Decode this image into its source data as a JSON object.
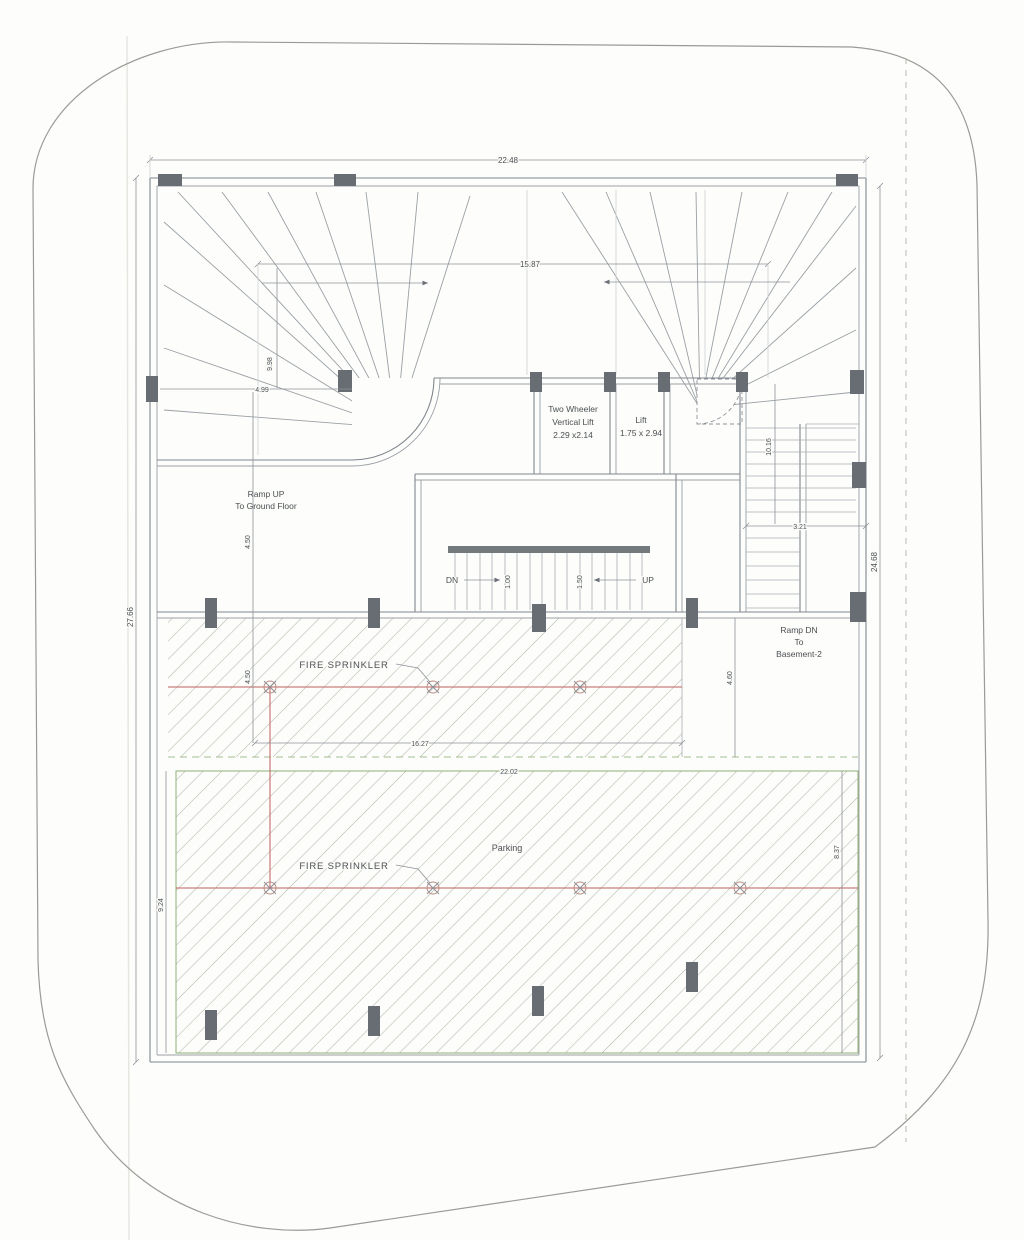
{
  "dims": {
    "top": "22.48",
    "inner_top": "15.87",
    "left": "27.66",
    "right": "24.68",
    "ramp_left_len": "9.98",
    "ramp_left_w": "4.99",
    "mid_left_a": "4.50",
    "mid_left_b": "4.50",
    "mid_right": "4.60",
    "ramp_dn_len": "10.16",
    "ramp_dn_w": "3.21",
    "parking_upper_w": "16.27",
    "parking_lower_w": "22.02",
    "lower_right": "8.37",
    "lower_left": "9.24",
    "stair_a": "1.00",
    "stair_b": "1.50"
  },
  "rooms": {
    "two_wheeler_lift": {
      "l1": "Two Wheeler",
      "l2": "Vertical Lift",
      "l3": "2.29 x2.14"
    },
    "lift": {
      "l1": "Lift",
      "l2": "1.75 x 2.94"
    },
    "parking": "Parking"
  },
  "ramps": {
    "up": {
      "l1": "Ramp UP",
      "l2": "To Ground Floor"
    },
    "down": {
      "l1": "Ramp DN",
      "l2": "To",
      "l3": "Basement-2"
    }
  },
  "stairs": {
    "dn": "DN",
    "up": "UP"
  },
  "annotations": {
    "fire_sprinkler_1": "FIRE SPRINKLER",
    "fire_sprinkler_2": "FIRE SPRINKLER"
  },
  "colors": {
    "hatch_green": "#a9b39c",
    "sprinkler_red": "#c0605c",
    "boundary_green": "#8fae74",
    "column_gray": "#686d73"
  }
}
